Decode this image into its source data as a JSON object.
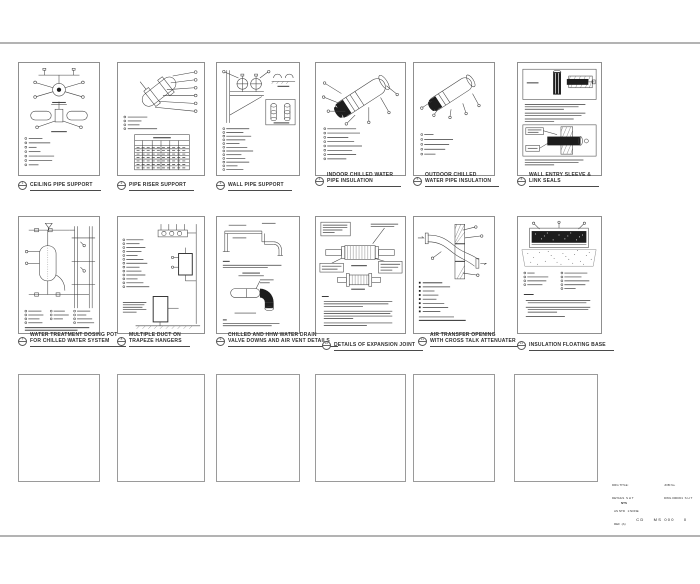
{
  "sheet": {
    "background": "#ffffff",
    "border_color": "#b3b3b3",
    "ink": "#3f3f3f"
  },
  "details": [
    {
      "callout": "1",
      "line1": "CEILING PIPE SUPPORT",
      "line2": ""
    },
    {
      "callout": "2",
      "line1": "PIPE RISER SUPPORT",
      "line2": ""
    },
    {
      "callout": "3",
      "line1": "WALL PIPE  SUPPORT",
      "line2": ""
    },
    {
      "callout": "4",
      "line1": "INDOOR CHILLED WATER",
      "line2": "PIPE INSULATION"
    },
    {
      "callout": "5",
      "line1": "OUTDOOR CHILLED",
      "line2": "WATER PIPE INSULATION"
    },
    {
      "callout": "6",
      "line1": "WALL ENTRY SLEEVE &",
      "line2": "LINK SEALS"
    },
    {
      "callout": "7",
      "line1": "WATER TREATMENT DOSING POT",
      "line2": "FOR CHILLED WATER SYSTEM"
    },
    {
      "callout": "8",
      "line1": "MULTIPLE DUCT ON",
      "line2": "TRAPEZE HANGERS"
    },
    {
      "callout": "9",
      "line1": "CHILLED AND HHW WATER DRAIN",
      "line2": "VALVE DOWNS AND AIR VENT DETAILS"
    },
    {
      "callout": "10",
      "line1": "DETAILS OF EXPANSION JOINT",
      "line2": ""
    },
    {
      "callout": "11",
      "line1": "AIR TRANSFER OPENING",
      "line2": "WITH CROSS TALK ATTENUATER"
    },
    {
      "callout": "12",
      "line1": "INSULATION FLOATING BASE",
      "line2": ""
    }
  ],
  "title_block": {
    "left1": "DRG TITLE:",
    "left2": "DETAILS  S H T",
    "right1": "JOB No.",
    "right2": "DWG 0000/01  S H T",
    "scale": "NTS",
    "note1": "AS NTD   1:NONE",
    "note2": "REF  (A)",
    "number": "CD    MS 000    0"
  }
}
